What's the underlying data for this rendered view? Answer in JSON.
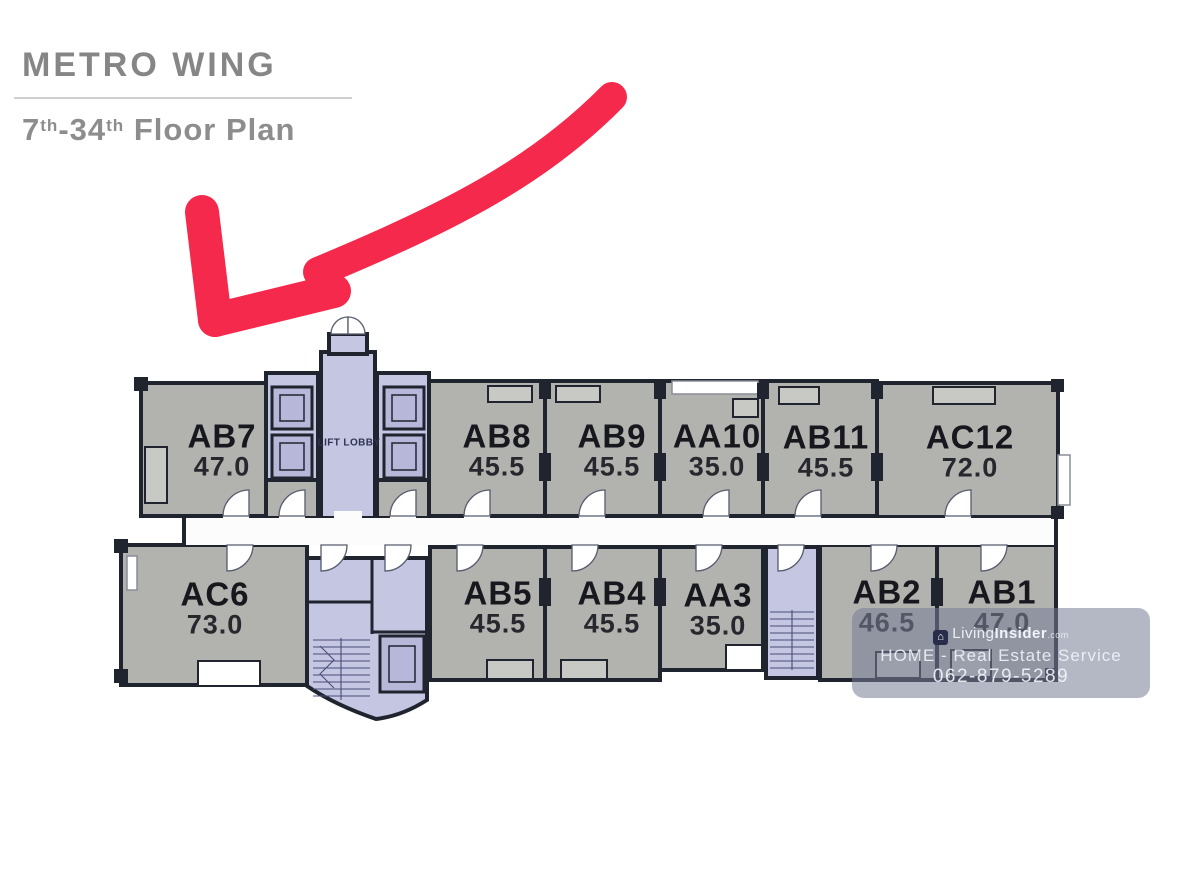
{
  "header": {
    "project_name": "METRO WING",
    "floor_range_start": "7",
    "floor_sup_1": "th",
    "floor_range_end": "-34",
    "floor_sup_2": "th",
    "floor_label": "Floor Plan"
  },
  "plan": {
    "lift_lobby_label": "LIFT LOBBY",
    "units": [
      {
        "id": "AB7",
        "area": "47.0"
      },
      {
        "id": "AB8",
        "area": "45.5"
      },
      {
        "id": "AB9",
        "area": "45.5"
      },
      {
        "id": "AA10",
        "area": "35.0"
      },
      {
        "id": "AB11",
        "area": "45.5"
      },
      {
        "id": "AC12",
        "area": "72.0"
      },
      {
        "id": "AC6",
        "area": "73.0"
      },
      {
        "id": "AB5",
        "area": "45.5"
      },
      {
        "id": "AB4",
        "area": "45.5"
      },
      {
        "id": "AA3",
        "area": "35.0"
      },
      {
        "id": "AB2",
        "area": "46.5"
      },
      {
        "id": "AB1",
        "area": "47.0"
      }
    ]
  },
  "watermark": {
    "brand_light": "Living",
    "brand_bold": "Insider",
    "brand_tld": ".com",
    "service_line": "HOME - Real Estate Service",
    "phone": "062-879-5289"
  },
  "colors": {
    "arrow": "#F5294B",
    "wall": "#20242F",
    "unit_fill": "#B2B2AF",
    "core_fill": "#C5C6E2",
    "title_gray": "#868686"
  }
}
